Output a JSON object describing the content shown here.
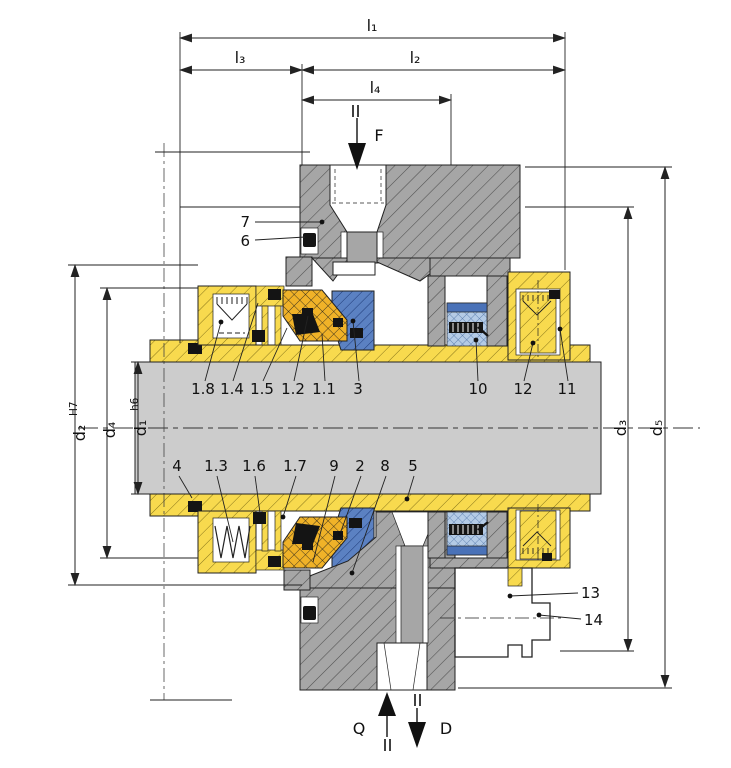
{
  "drawing": {
    "type": "mechanical-seal-cross-section",
    "dimensions": {
      "l1": "l₁",
      "l2": "l₂",
      "l3": "l₃",
      "l4": "l₄",
      "d1": "d₁",
      "d1_tolerance": "h6",
      "d2": "d₂",
      "d2_tolerance": "H7",
      "d3": "d₃",
      "d4": "d₄",
      "d5": "d₅"
    },
    "flow_labels": {
      "force": "F",
      "quench": "Q",
      "drain": "D"
    },
    "part_callouts": {
      "upper_left": [
        "7",
        "6"
      ],
      "upper_row": [
        "1.8",
        "1.4",
        "1.5",
        "1.2",
        "1.1",
        "3",
        "10",
        "12",
        "11"
      ],
      "lower_row": [
        "4",
        "1.3",
        "1.6",
        "1.7",
        "9",
        "2",
        "8",
        "5"
      ],
      "lower_right": [
        "13",
        "14"
      ]
    },
    "colors": {
      "housing_gray": "#a6a6a6",
      "shaft_gray": "#cccccc",
      "sleeve_yellow": "#f8da4e",
      "elastomer_orange": "#f0b228",
      "seal_ring_blue": "#5b81c2",
      "spring_unit_blue": "#b4cbe6",
      "seal_black": "#141414",
      "line": "#222222",
      "background": "#ffffff"
    }
  }
}
